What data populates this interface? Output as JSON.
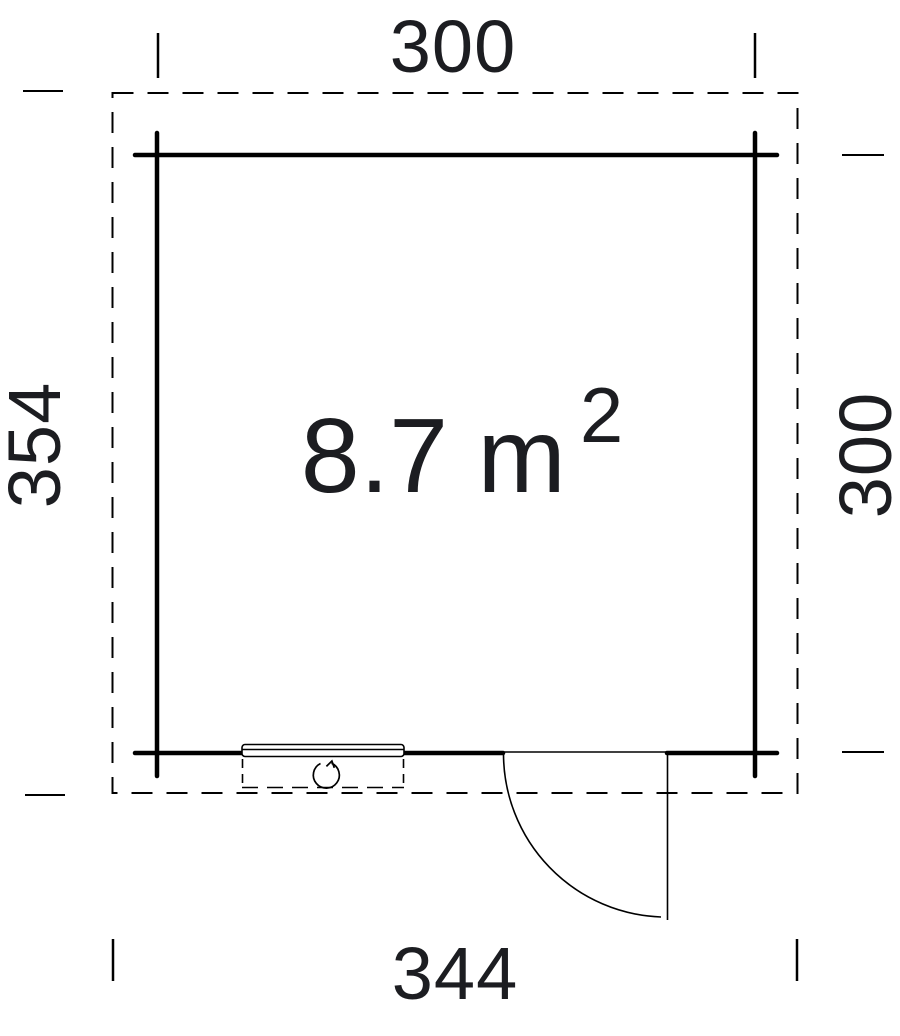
{
  "colors": {
    "line": "#000000",
    "text": "#1c1d21",
    "background": "#ffffff"
  },
  "floor_plan": {
    "type": "garden-house plan view",
    "area_label": {
      "value": "8.7 m",
      "superscript": "2"
    },
    "dimensions": {
      "top_width": "300",
      "left_height": "354",
      "right_height": "300",
      "bottom_width": "344"
    }
  }
}
